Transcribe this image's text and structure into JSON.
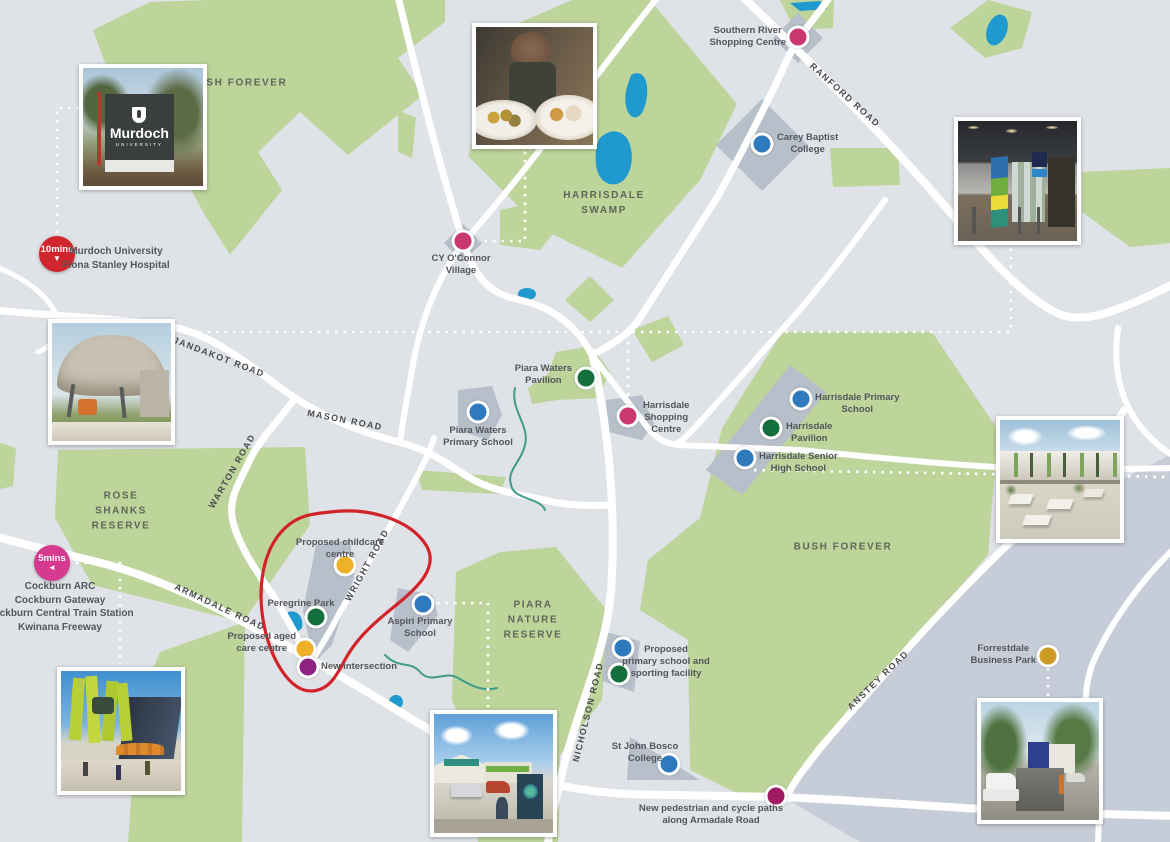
{
  "areas": {
    "bush_forever_nw": "BUSH FOREVER",
    "harrisdale_swamp": "HARRISDALE\nSWAMP",
    "rose_shanks_reserve": "ROSE\nSHANKS\nRESERVE",
    "piara_nature_reserve": "PIARA\nNATURE\nRESERVE",
    "bush_forever_east": "BUSH FOREVER"
  },
  "roads": {
    "jandakot": "JANDAKOT ROAD",
    "mason": "MASON ROAD",
    "warton": "WARTON ROAD",
    "ranford": "RANFORD ROAD",
    "armadale": "ARMADALE ROAD",
    "wright": "WRIGHT ROAD",
    "nicholson": "NICHOLSON ROAD",
    "anstey": "ANSTEY ROAD"
  },
  "travel_pins": [
    {
      "time": "10mins",
      "arrow": "▼",
      "destinations": "Murdoch University\nFiona Stanley Hospital",
      "color": "#d1252d"
    },
    {
      "time": "5mins",
      "arrow": "◄",
      "destinations": "Cockburn ARC\nCockburn Gateway\nCockburn Central Train Station\nKwinana Freeway",
      "color": "#d63a8e"
    }
  ],
  "markers": [
    {
      "id": "southern-river-shopping-centre",
      "label": "Southern River\nShopping Centre",
      "color": "#c9386f"
    },
    {
      "id": "carey-baptist-college",
      "label": "Carey Baptist\nCollege",
      "color": "#2e7abd"
    },
    {
      "id": "cy-oconnor-village",
      "label": "CY O'Connor\nVillage",
      "color": "#c9386f"
    },
    {
      "id": "piara-waters-pavilion",
      "label": "Piara Waters\nPavilion",
      "color": "#156f3c"
    },
    {
      "id": "piara-waters-primary-school",
      "label": "Piara Waters\nPrimary School",
      "color": "#2e7abd"
    },
    {
      "id": "harrisdale-shopping-centre",
      "label": "Harrisdale\nShopping\nCentre",
      "color": "#c9386f"
    },
    {
      "id": "harrisdale-primary-school",
      "label": "Harrisdale Primary\nSchool",
      "color": "#2e7abd"
    },
    {
      "id": "harrisdale-pavilion",
      "label": "Harrisdale\nPavilion",
      "color": "#156f3c"
    },
    {
      "id": "harrisdale-senior-high-school",
      "label": "Harrisdale Senior\nHigh School",
      "color": "#2e7abd"
    },
    {
      "id": "aspiri-primary-school",
      "label": "Aspiri Primary\nSchool",
      "color": "#2e7abd"
    },
    {
      "id": "proposed-childcare-centre",
      "label": "Proposed childcare\ncentre",
      "color": "#efb125"
    },
    {
      "id": "peregrine-park",
      "label": "Peregrine Park",
      "color": "#156f3c"
    },
    {
      "id": "proposed-aged-care-centre",
      "label": "Proposed aged\ncare centre",
      "color": "#efb125"
    },
    {
      "id": "new-intersection",
      "label": "New intersection",
      "color": "#8e2281"
    },
    {
      "id": "proposed-primary-school-sporting",
      "label": "Proposed\nprimary school and\nsporting facility",
      "color": "#2e7abd",
      "color2": "#156f3c"
    },
    {
      "id": "st-john-bosco-college",
      "label": "St John Bosco\nCollege",
      "color": "#2e7abd"
    },
    {
      "id": "new-pedestrian-cycle-paths",
      "label": "New pedestrian and cycle paths\nalong Armadale Road",
      "color": "#a01a64"
    },
    {
      "id": "forrestdale-business-park",
      "label": "Forrestdale\nBusiness Park",
      "color": "#cc9a27"
    }
  ],
  "murdoch_sign": {
    "name": "Murdoch",
    "subtitle": "UNIVERSITY"
  },
  "photos": [
    {
      "id": "murdoch-university-sign"
    },
    {
      "id": "tavern-food"
    },
    {
      "id": "shopping-centre-interior"
    },
    {
      "id": "park-pavilion-shade-structure"
    },
    {
      "id": "school-courtyard"
    },
    {
      "id": "cockburn-gateway-shopping-centre"
    },
    {
      "id": "aspiri-primary-school-building"
    },
    {
      "id": "forrestdale-business-park-street"
    }
  ],
  "map_colors": {
    "background": "#dfe2e6",
    "parkland": "#bdd49b",
    "parcel": "#b7bfca",
    "district_slab": "#c7cdd8",
    "water": "#2099ce",
    "road": "#ffffff",
    "annotation_circle": "#d2232a"
  }
}
